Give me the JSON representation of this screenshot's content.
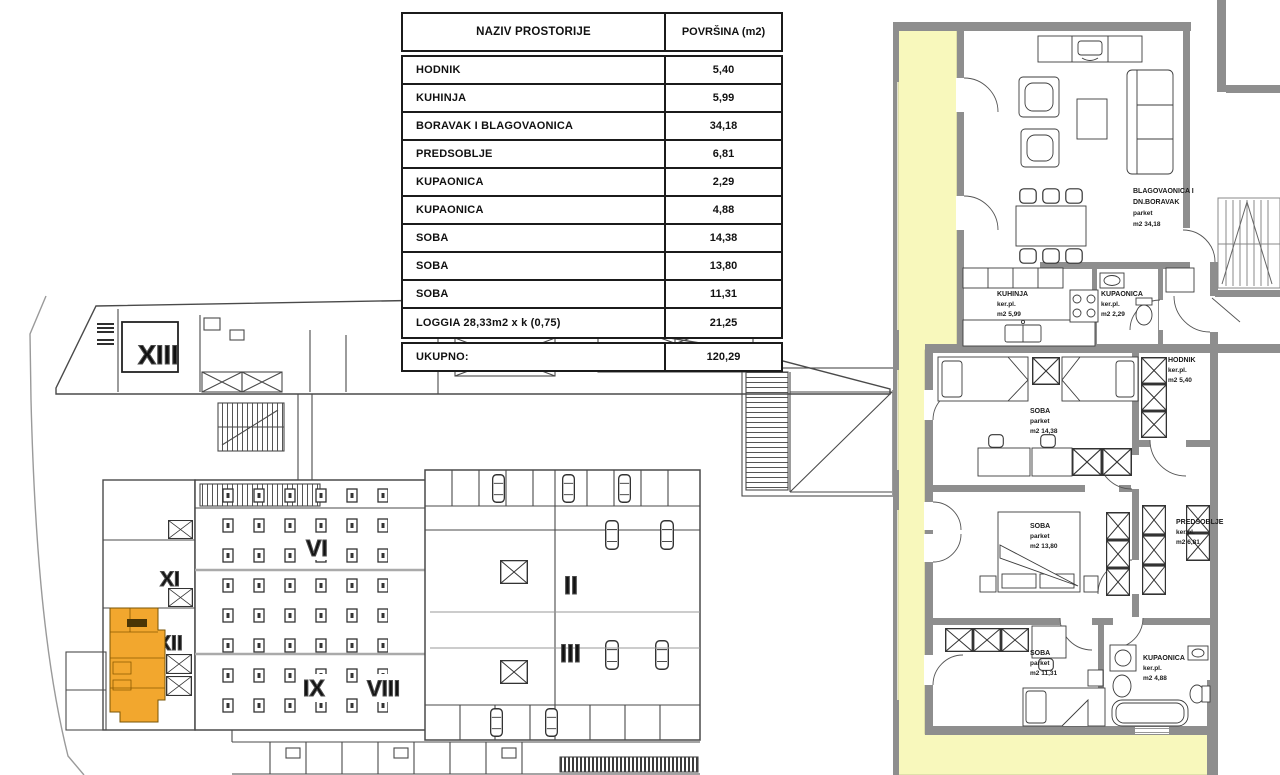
{
  "area_table": {
    "header": {
      "name_col": "NAZIV PROSTORIJE",
      "area_col": "POVRŠINA  (m2)"
    },
    "rows": [
      {
        "name": "HODNIK",
        "area": "5,40"
      },
      {
        "name": "KUHINJA",
        "area": "5,99"
      },
      {
        "name": "BORAVAK I BLAGOVAONICA",
        "area": "34,18"
      },
      {
        "name": "PREDSOBLJE",
        "area": "6,81"
      },
      {
        "name": "KUPAONICA",
        "area": "2,29"
      },
      {
        "name": "KUPAONICA",
        "area": "4,88"
      },
      {
        "name": "SOBA",
        "area": "14,38"
      },
      {
        "name": "SOBA",
        "area": "13,80"
      },
      {
        "name": "SOBA",
        "area": "11,31"
      },
      {
        "name": "LOGGIA 28,33m2 x k (0,75)",
        "area": "21,25"
      }
    ],
    "total": {
      "name": "UKUPNO:",
      "area": "120,29"
    }
  },
  "site_plan": {
    "highlight_color": "#F2A72E",
    "labels": {
      "unit_13": "XIII",
      "unit_11": "XI",
      "unit_12": "XII",
      "unit_6": "VI",
      "unit_9": "IX",
      "unit_8": "VIII",
      "unit_2": "II",
      "unit_3": "III"
    }
  },
  "apartment_plan": {
    "loggia_color": "#F8F8BC",
    "wall_color": "#8E8E8E",
    "rooms": {
      "living": {
        "l1": "BLAGOVAONICA I",
        "l2": "DN.BORAVAK",
        "l3": "parket",
        "l4": "m2  34,18"
      },
      "kitchen": {
        "l1": "KUHINJA",
        "l2": "ker.pl.",
        "l3": "m2  5,99"
      },
      "bath_small": {
        "l1": "KUPAONICA",
        "l2": "ker.pl.",
        "l3": "m2  2,29"
      },
      "hallway": {
        "l1": "HODNIK",
        "l2": "ker.pl.",
        "l3": "m2  5,40"
      },
      "bedroom_1": {
        "l1": "SOBA",
        "l2": "parket",
        "l3": "m2  14,38"
      },
      "bedroom_2": {
        "l1": "SOBA",
        "l2": "parket",
        "l3": "m2  13,80"
      },
      "entry": {
        "l1": "PREDSOBLJE",
        "l2": "ker.pl.",
        "l3": "m2  6,81"
      },
      "bedroom_3": {
        "l1": "SOBA",
        "l2": "parket",
        "l3": "m2  11,31"
      },
      "bath_main": {
        "l1": "KUPAONICA",
        "l2": "ker.pl.",
        "l3": "m2  4,88"
      }
    }
  }
}
